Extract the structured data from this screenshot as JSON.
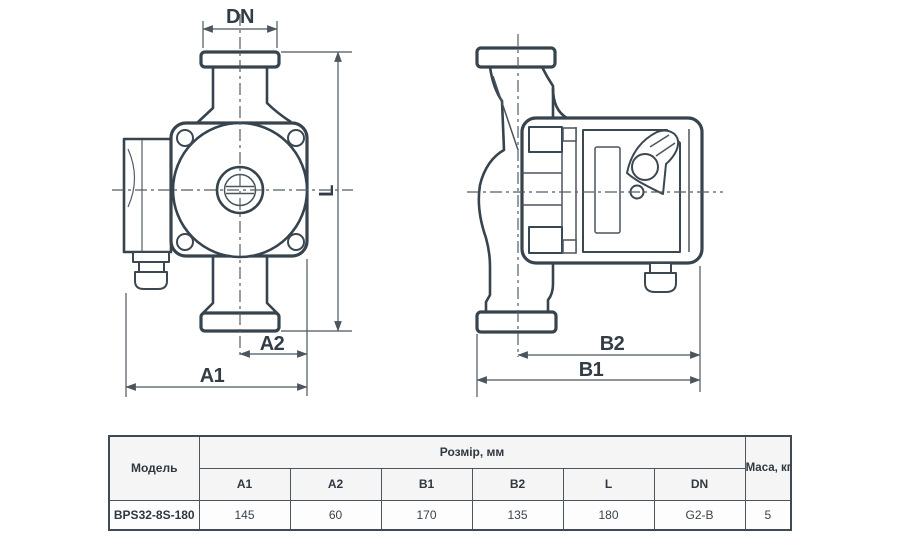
{
  "page": {
    "background": "#ffffff",
    "line_color": "#37434d"
  },
  "drawings": {
    "front_view": {
      "dim_dn": "DN",
      "dim_l": "L",
      "dim_a2": "A2",
      "dim_a1": "A1"
    },
    "side_view": {
      "dim_b2": "B2",
      "dim_b1": "B1"
    }
  },
  "table": {
    "model_header": "Модель",
    "size_header": "Розмір, мм",
    "mass_header": "Маса, кг",
    "size_columns": [
      "A1",
      "A2",
      "B1",
      "B2",
      "L",
      "DN"
    ],
    "rows": [
      {
        "model": "BPS32-8S-180",
        "sizes": [
          "145",
          "60",
          "170",
          "135",
          "180",
          "G2-B"
        ],
        "mass": "5"
      }
    ]
  }
}
